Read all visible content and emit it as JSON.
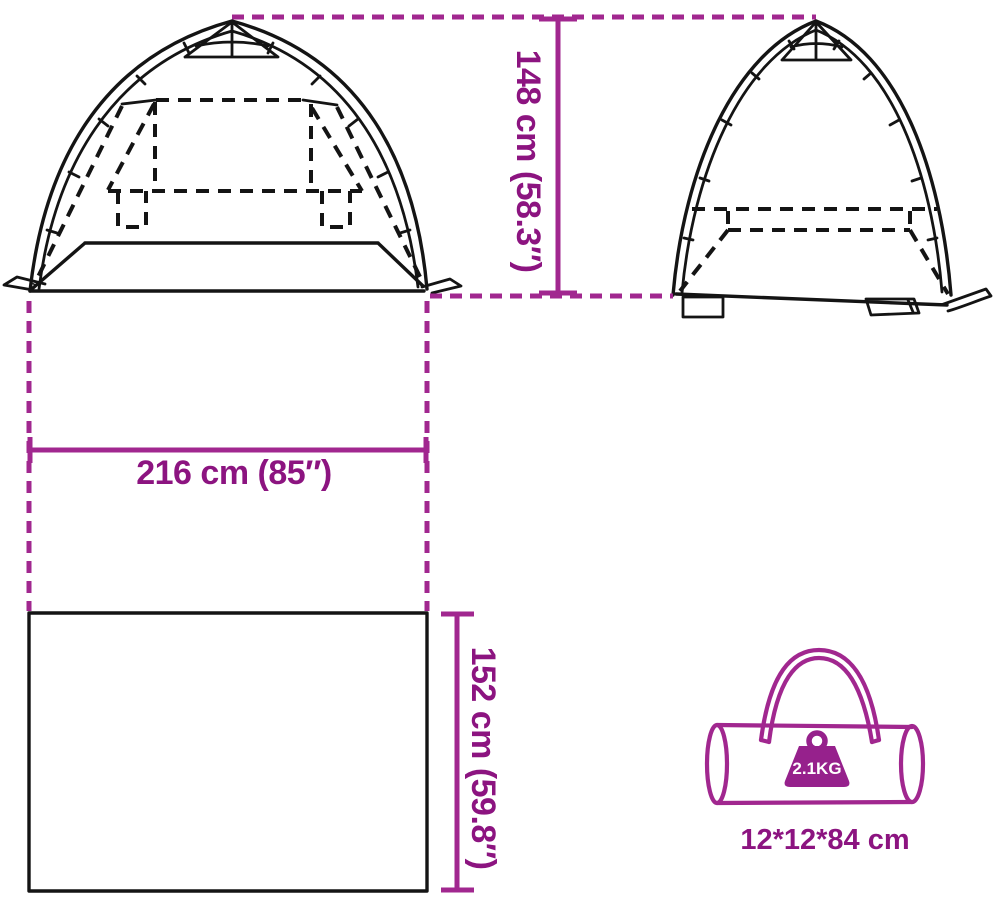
{
  "diagram_title": "tent-dimensions-diagram",
  "dimensions": {
    "tent_height": "148 cm (58.3″)",
    "tent_width": "216 cm (85″)",
    "tent_depth": "152 cm (59.8″)"
  },
  "bag": {
    "weight": "2.1KG",
    "packed_size": "12*12*84 cm"
  },
  "icons": {
    "front_view": "tent-front-view",
    "side_view": "tent-side-view",
    "carry_bag": "carry-bag-icon",
    "weight_badge": "weight-icon"
  },
  "colors": {
    "accent_text": "#8C1480",
    "accent_line": "#A1278F",
    "accent_fill": "#96218C",
    "ink": "#141414",
    "background": "#FFFFFF"
  }
}
